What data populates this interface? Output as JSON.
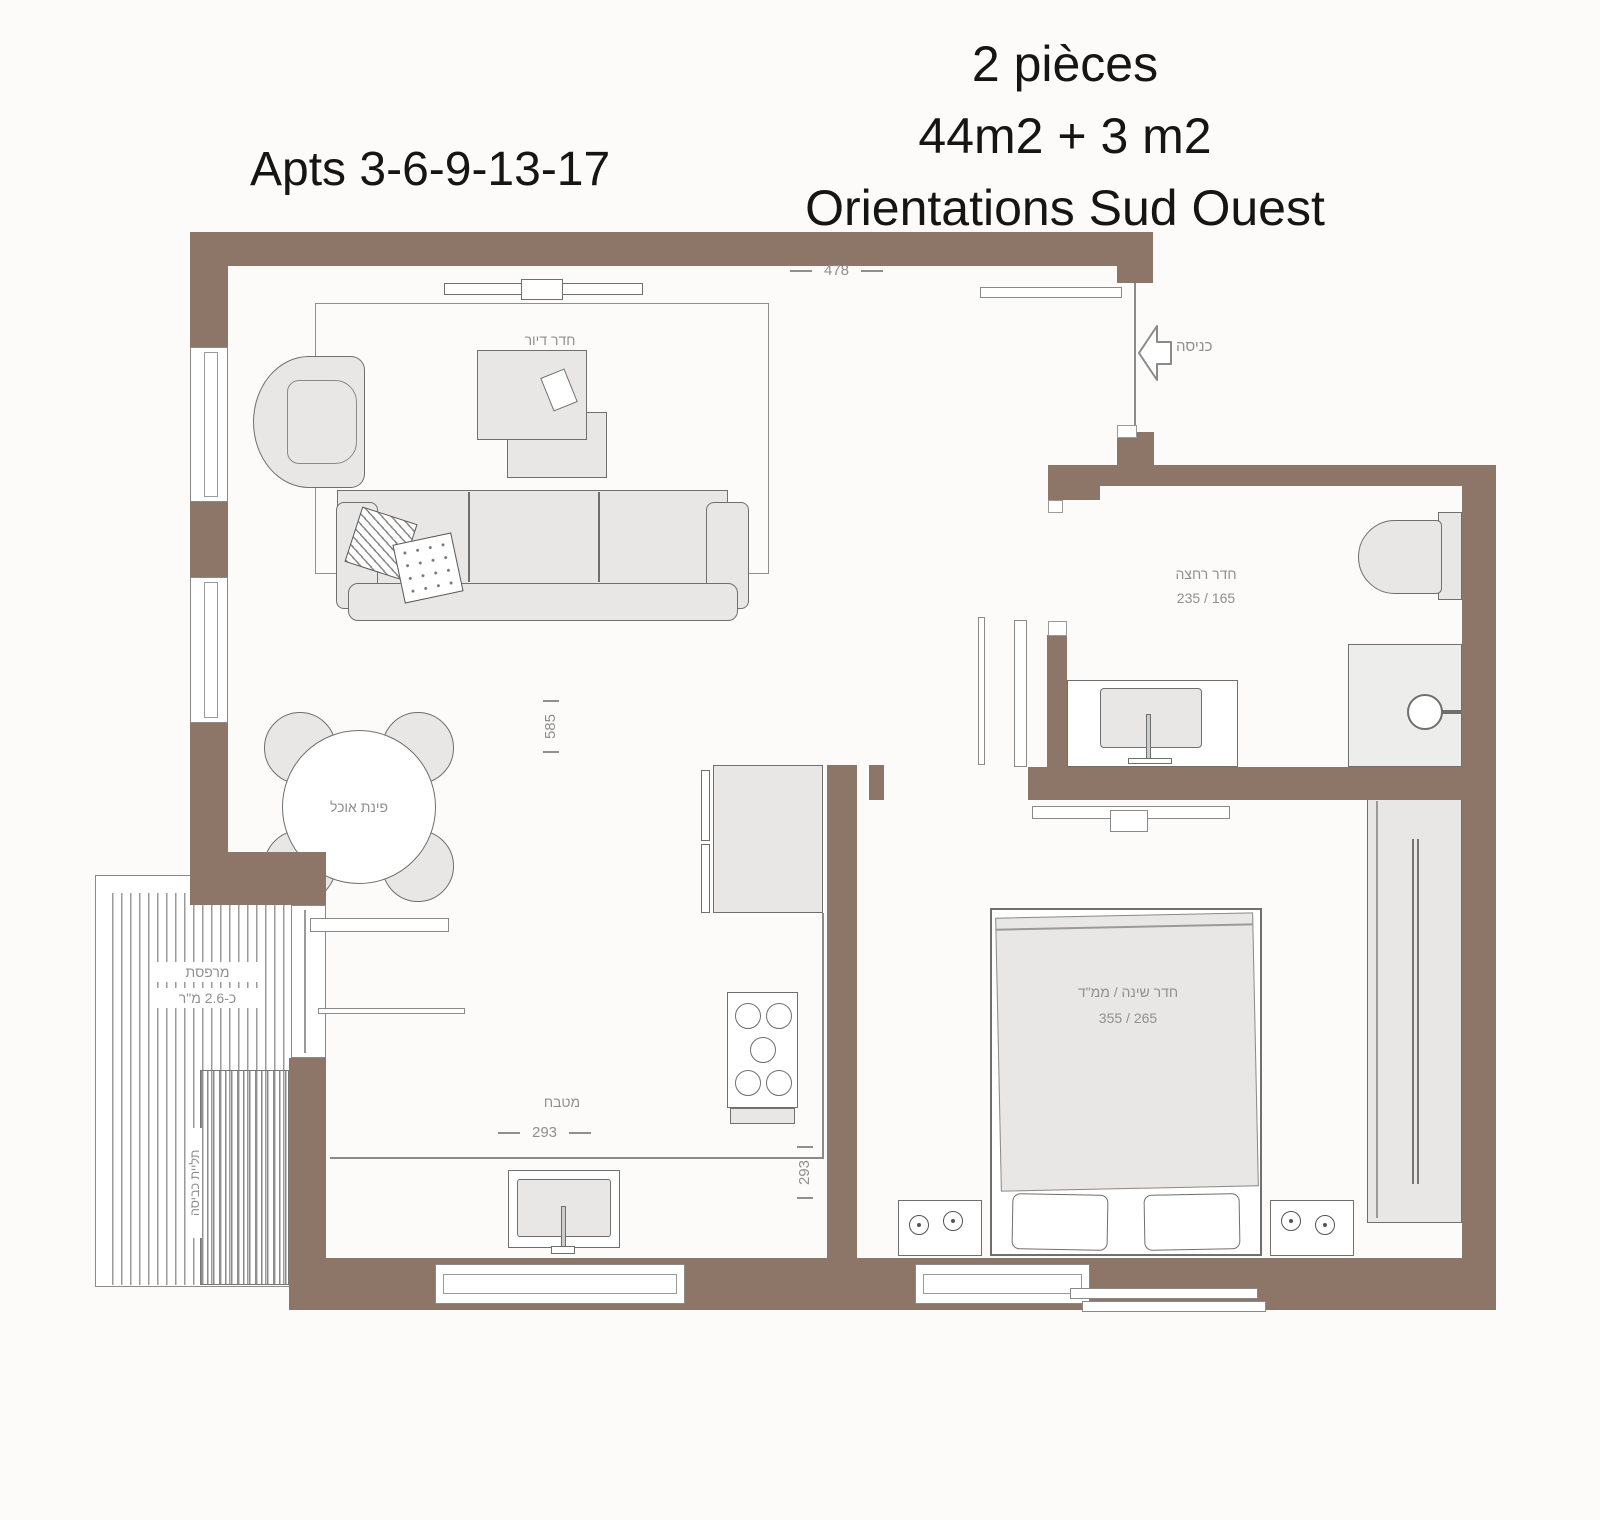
{
  "titles": {
    "left": "Apts 3-6-9-13-17",
    "right_line1": "2 pièces",
    "right_line2": "44m2 + 3 m2",
    "right_line3": "Orientations Sud Ouest"
  },
  "rooms": {
    "living": {
      "label": "חדר דיור"
    },
    "dining": {
      "label": "פינת אוכל"
    },
    "kitchen": {
      "label": "מטבח"
    },
    "bathroom": {
      "label": "חדר רחצה",
      "dims": "235 / 165"
    },
    "bedroom": {
      "label": "חדר שינה / ממ\"ד",
      "dims": "355 / 265"
    },
    "balcony": {
      "label": "מרפסת",
      "area": "כ-2.6 מ\"ר",
      "note": "תליית כביסה"
    },
    "entrance": {
      "label": "כניסה"
    }
  },
  "dimensions": {
    "top_width": "478",
    "living_height": "585",
    "kitchen_width": "293",
    "kitchen_depth": "293"
  },
  "colors": {
    "wall": "#8d7567",
    "furniture_fill": "#e8e7e5",
    "outline": "#6f6f6f",
    "label_gray": "#8f8f8f"
  }
}
